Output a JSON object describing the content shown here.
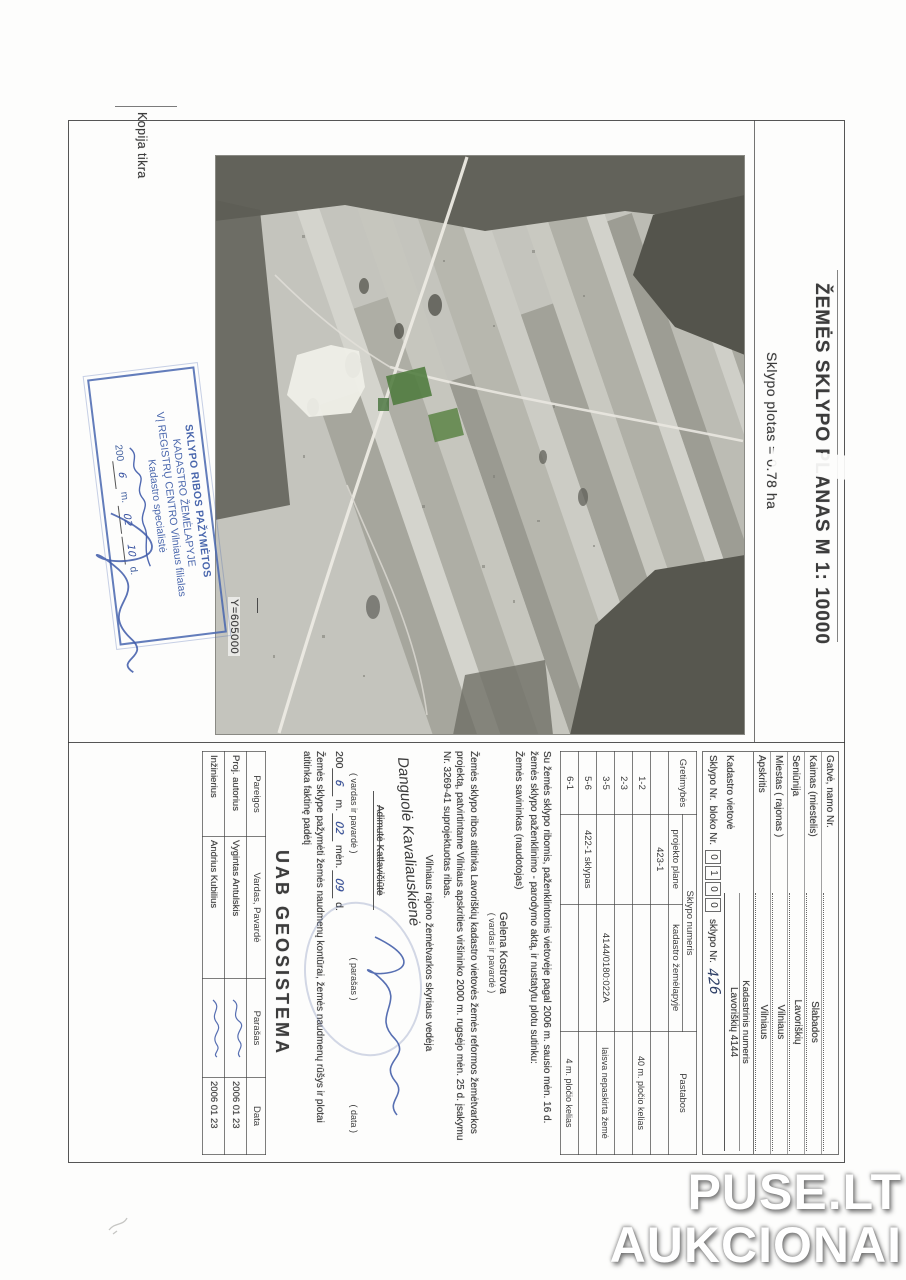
{
  "page": {
    "copy_note": "Kopija tikra",
    "coord_label": "Y=605000"
  },
  "title": {
    "main": "ŽEMĖS SKLYPO PLANAS M 1: 10000",
    "subtitle": "Sklypo plotas = 0.78 ha"
  },
  "watermark": {
    "line1": "PUSE.LT",
    "line2": "AUKCIONAI"
  },
  "stamp": {
    "line1": "SKLYPO RIBOS PAŽYMĖTOS",
    "line2": "KADASTRO ŽEMĖLAPYJE",
    "line3": "VĮ REGISTRŲ CENTRO Vilniaus filialas",
    "line4": "Kadastro specialistė",
    "date_prefix": "200",
    "m_label": "m.",
    "d_label": "d.",
    "hand_year": "6",
    "hand_month": "02",
    "hand_day": "10"
  },
  "address": {
    "rows": [
      {
        "label": "Gatvė, namo Nr.",
        "value": ""
      },
      {
        "label": "Kaimas (miestelis)",
        "value": "Slabados"
      },
      {
        "label": "Seniūnija",
        "value": "Lavoriškių"
      },
      {
        "label": "Miestas ( rajonas )",
        "value": "Vilniaus"
      },
      {
        "label": "Apskritis",
        "value": "Vilniaus"
      }
    ]
  },
  "cadastre": {
    "header": "Kadastrinis numeris",
    "vietove_label": "Kadastro vietovė",
    "vietove_value": "Lavoriškių 4144",
    "sklypo_label": "Sklypo Nr.",
    "bloko_label": "bloko Nr.",
    "digits": [
      "0",
      "1",
      "0",
      "0"
    ],
    "sklypo_nr_label": "sklypo Nr.",
    "sklypo_nr_value": "426"
  },
  "adjacency": {
    "col1": "Gretimybės",
    "col2": "Sklypo numeris",
    "col2a": "projekto plane",
    "col2b": "kadastro žemėlapyje",
    "col3": "Pastabos",
    "rows": [
      [
        "",
        "423-1",
        "",
        ""
      ],
      [
        "1-2",
        "",
        "",
        "40 m. pločio kelias"
      ],
      [
        "2-3",
        "",
        "",
        ""
      ],
      [
        "3-5",
        "",
        "4144/0180:022A",
        "laisva nepaskirta žemė"
      ],
      [
        "5-6",
        "422-1 sklypas",
        "",
        ""
      ],
      [
        "6-1",
        "",
        "",
        "4 m. pločio kelias"
      ]
    ]
  },
  "consent": {
    "text": "Su žemės sklypo ribomis, paženklintomis vietovėje pagal 2006 m. sausio mėn. 16 d. žemės sklypo paženklinimo - parodymo aktą, ir nustatytu plotu sutinku:",
    "role": "Žemės savininkas (naudotojas)",
    "name": "Gelena Kostrova",
    "caption": "( vardas ir pavardė )"
  },
  "project_text": "Žemės sklypo ribos atitinka Lavoriškių kadastro vietovės žemės reformos žemėtvarkos projektą, patvirtintame Vilniaus apskrities viršininko 2000 m. rugsėjo mėn. 25 d. įsakymu Nr. 3269-41 suprojektuotas ribas.",
  "approval": {
    "role": "Vilniaus rajono žemėtvarkos skyriaus vedėja",
    "printed_name": "Adimutė Katlavičiūtė",
    "hand_name": "Danguolė Kavaliauskienė",
    "cap_name": "( vardas ir pavardė )",
    "cap_sig": "( parašas )",
    "cap_date": "( data )",
    "date_prefix": "200",
    "hand_year": "6",
    "m_label": "m.",
    "hand_month": "02",
    "men_label": "mėn.",
    "hand_day": "09",
    "d_label": "d."
  },
  "statement": "Žemės sklype pažymėti žemės naudmenų kontūrai, žemės naudmenų rūšys ir plotai atitinka faktinę padėtį",
  "company": {
    "name": "UAB GEOSISTEMA",
    "headers": [
      "Pareigos",
      "Vardas, Pavardė",
      "Parašas",
      "Data"
    ],
    "rows": [
      {
        "role": "Proj. autorius",
        "name": "Vygintas Antulskis",
        "date": "2006 01 23"
      },
      {
        "role": "Inžinierius",
        "name": "Andrius Kubilius",
        "date": "2006 01 23"
      }
    ]
  },
  "colors": {
    "stamp_blue": "#4a67ad",
    "ink_blue": "#3a56a5",
    "map_green": "#4e7b3e",
    "paper": "#fdfdfc"
  }
}
